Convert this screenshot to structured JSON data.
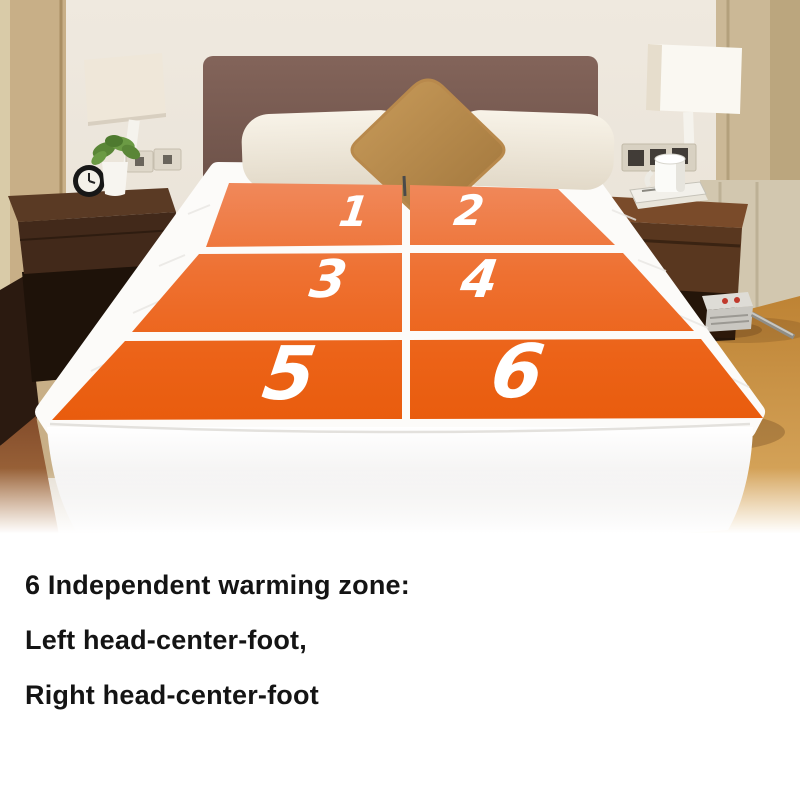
{
  "diagram": {
    "zones": [
      {
        "label": "1"
      },
      {
        "label": "2"
      },
      {
        "label": "3"
      },
      {
        "label": "4"
      },
      {
        "label": "5"
      },
      {
        "label": "6"
      }
    ],
    "caption_lines": [
      "6 Independent warming zone:",
      "Left head-center-foot,",
      "Right head-center-foot"
    ],
    "colors": {
      "zone_orange_top": "#F0895C",
      "zone_orange_bottom": "#E95C0D",
      "zone_number_text": "#FFFFFF",
      "caption_text": "#141414",
      "page_background": "#FFFFFF"
    }
  }
}
